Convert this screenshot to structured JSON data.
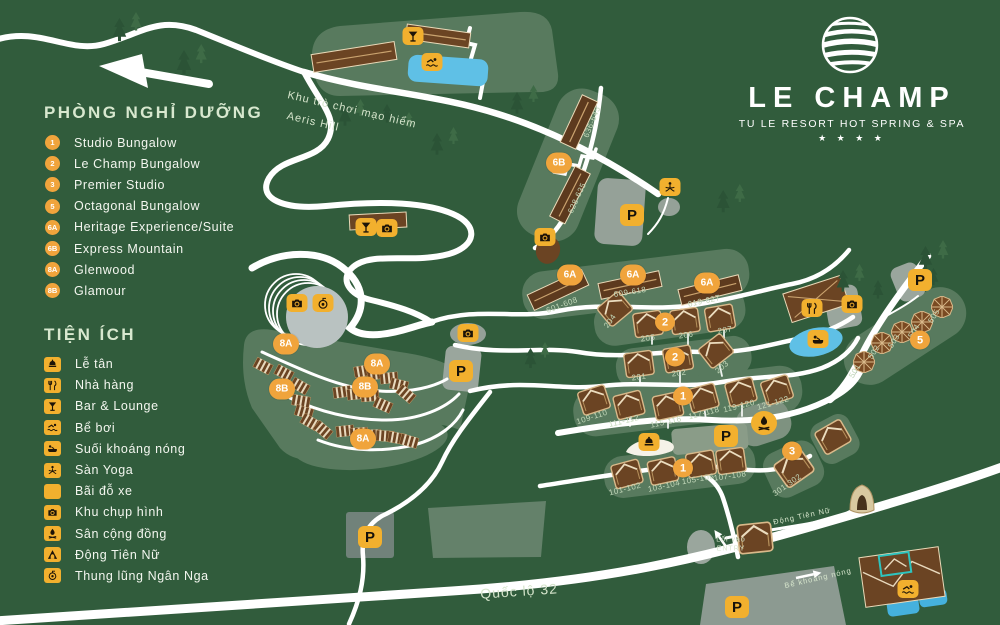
{
  "logo": {
    "name": "LE CHAMP",
    "tagline": "TU LE RESORT HOT SPRING & SPA",
    "stars": "★ ★ ★ ★"
  },
  "legend": {
    "rooms_heading": "PHÒNG NGHỈ DƯỠNG",
    "rooms": [
      {
        "badge": "1",
        "label": "Studio Bungalow"
      },
      {
        "badge": "2",
        "label": "Le Champ Bungalow"
      },
      {
        "badge": "3",
        "label": "Premier Studio"
      },
      {
        "badge": "5",
        "label": "Octagonal Bungalow"
      },
      {
        "badge": "6A",
        "label": "Heritage Experience/Suite"
      },
      {
        "badge": "6B",
        "label": "Express Mountain"
      },
      {
        "badge": "8A",
        "label": "Glenwood"
      },
      {
        "badge": "8B",
        "label": "Glamour"
      }
    ],
    "facilities_heading": "TIỆN ÍCH",
    "facilities": [
      {
        "icon": "reception-icon",
        "label": "Lễ tân"
      },
      {
        "icon": "restaurant-icon",
        "label": "Nhà hàng"
      },
      {
        "icon": "bar-icon",
        "label": "Bar & Lounge"
      },
      {
        "icon": "pool-icon",
        "label": "Bể bơi"
      },
      {
        "icon": "hot-spring-icon",
        "label": "Suối khoáng nóng"
      },
      {
        "icon": "yoga-icon",
        "label": "Sàn Yoga"
      },
      {
        "icon": "parking-icon",
        "label": "Bãi đỗ xe"
      },
      {
        "icon": "photo-icon",
        "label": "Khu chụp hình"
      },
      {
        "icon": "community-icon",
        "label": "Sân cộng đồng"
      },
      {
        "icon": "cave-icon",
        "label": "Động Tiên Nữ"
      },
      {
        "icon": "valley-icon",
        "label": "Thung lũng Ngân Nga"
      }
    ]
  },
  "map": {
    "road_labels": [
      {
        "text": "Khu trò chơi mạo hiểm",
        "x": 352,
        "y": 110,
        "rot": 13,
        "size": 11
      },
      {
        "text": "Aeris Hill",
        "x": 313,
        "y": 122,
        "rot": 13,
        "size": 11
      },
      {
        "text": "Quốc lộ 32",
        "x": 519,
        "y": 591,
        "rot": -4,
        "size": 14
      },
      {
        "text": "Động Tiên Nữ",
        "x": 802,
        "y": 516,
        "rot": -12,
        "size": 7.5
      },
      {
        "text": "Lối vào",
        "x": 731,
        "y": 540,
        "rot": 0,
        "size": 7
      },
      {
        "text": "ENTRY",
        "x": 731,
        "y": 549,
        "rot": 0,
        "size": 7
      },
      {
        "text": "Bể khoáng nóng",
        "x": 818,
        "y": 578,
        "rot": -13,
        "size": 7.5
      }
    ],
    "unit_labels": [
      {
        "text": "636-645",
        "x": 592,
        "y": 122,
        "rot": -68
      },
      {
        "text": "628-635",
        "x": 577,
        "y": 198,
        "rot": -65
      },
      {
        "text": "601-608",
        "x": 562,
        "y": 305,
        "rot": -20
      },
      {
        "text": "609-618",
        "x": 630,
        "y": 292,
        "rot": -9
      },
      {
        "text": "619-627",
        "x": 704,
        "y": 301,
        "rot": -12
      },
      {
        "text": "204",
        "x": 610,
        "y": 321,
        "rot": -55
      },
      {
        "text": "205",
        "x": 648,
        "y": 338,
        "rot": -8
      },
      {
        "text": "206",
        "x": 686,
        "y": 335,
        "rot": -8
      },
      {
        "text": "207",
        "x": 725,
        "y": 330,
        "rot": -10
      },
      {
        "text": "201",
        "x": 639,
        "y": 377,
        "rot": -8
      },
      {
        "text": "202",
        "x": 679,
        "y": 373,
        "rot": -8
      },
      {
        "text": "203",
        "x": 722,
        "y": 367,
        "rot": -40
      },
      {
        "text": "109-110",
        "x": 592,
        "y": 417,
        "rot": -18
      },
      {
        "text": "111-112",
        "x": 624,
        "y": 421,
        "rot": -14
      },
      {
        "text": "115-116",
        "x": 666,
        "y": 422,
        "rot": -12
      },
      {
        "text": "117-118",
        "x": 704,
        "y": 413,
        "rot": -14
      },
      {
        "text": "119-120",
        "x": 739,
        "y": 406,
        "rot": -14
      },
      {
        "text": "121-122",
        "x": 773,
        "y": 403,
        "rot": -16
      },
      {
        "text": "101-102",
        "x": 625,
        "y": 489,
        "rot": -14
      },
      {
        "text": "103-104",
        "x": 664,
        "y": 486,
        "rot": -12
      },
      {
        "text": "105-106",
        "x": 698,
        "y": 479,
        "rot": -10
      },
      {
        "text": "107-108",
        "x": 730,
        "y": 476,
        "rot": -8
      },
      {
        "text": "301-302",
        "x": 787,
        "y": 485,
        "rot": -35
      },
      {
        "text": "501",
        "x": 855,
        "y": 371,
        "rot": -58
      },
      {
        "text": "502",
        "x": 874,
        "y": 352,
        "rot": -58
      },
      {
        "text": "503",
        "x": 894,
        "y": 341,
        "rot": -58
      },
      {
        "text": "504",
        "x": 914,
        "y": 331,
        "rot": -58
      },
      {
        "text": "505",
        "x": 934,
        "y": 316,
        "rot": -58
      }
    ],
    "room_markers": [
      {
        "text": "6B",
        "x": 559,
        "y": 163
      },
      {
        "text": "6A",
        "x": 570,
        "y": 275
      },
      {
        "text": "6A",
        "x": 633,
        "y": 275
      },
      {
        "text": "6A",
        "x": 707,
        "y": 283
      },
      {
        "text": "2",
        "x": 665,
        "y": 322
      },
      {
        "text": "2",
        "x": 675,
        "y": 357
      },
      {
        "text": "1",
        "x": 683,
        "y": 396
      },
      {
        "text": "1",
        "x": 683,
        "y": 468
      },
      {
        "text": "3",
        "x": 792,
        "y": 451
      },
      {
        "text": "5",
        "x": 920,
        "y": 340
      },
      {
        "text": "8A",
        "x": 286,
        "y": 344
      },
      {
        "text": "8A",
        "x": 377,
        "y": 364
      },
      {
        "text": "8B",
        "x": 282,
        "y": 389
      },
      {
        "text": "8B",
        "x": 365,
        "y": 387
      },
      {
        "text": "8A",
        "x": 363,
        "y": 439
      }
    ],
    "facility_markers": [
      {
        "icon": "bar-icon",
        "x": 413,
        "y": 36,
        "kind": "sq"
      },
      {
        "icon": "pool-icon",
        "x": 432,
        "y": 62,
        "kind": "sq"
      },
      {
        "icon": "photo-icon",
        "x": 545,
        "y": 237,
        "kind": "sq"
      },
      {
        "icon": "parking-icon",
        "x": 632,
        "y": 215,
        "kind": "p"
      },
      {
        "icon": "yoga-icon",
        "x": 670,
        "y": 187,
        "kind": "sq"
      },
      {
        "icon": "photo-icon",
        "x": 297,
        "y": 303,
        "kind": "sq"
      },
      {
        "icon": "valley-icon",
        "x": 323,
        "y": 303,
        "kind": "sq"
      },
      {
        "icon": "bar-icon",
        "x": 366,
        "y": 227,
        "kind": "sq"
      },
      {
        "icon": "photo-icon",
        "x": 387,
        "y": 228,
        "kind": "sq"
      },
      {
        "icon": "photo-icon",
        "x": 468,
        "y": 333,
        "kind": "sq"
      },
      {
        "icon": "parking-icon",
        "x": 461,
        "y": 371,
        "kind": "p"
      },
      {
        "icon": "parking-icon",
        "x": 370,
        "y": 537,
        "kind": "p"
      },
      {
        "icon": "reception-icon",
        "x": 649,
        "y": 442,
        "kind": "sq"
      },
      {
        "icon": "parking-icon",
        "x": 726,
        "y": 436,
        "kind": "p"
      },
      {
        "icon": "community-icon",
        "x": 764,
        "y": 423,
        "kind": "round"
      },
      {
        "icon": "parking-icon",
        "x": 920,
        "y": 280,
        "kind": "p"
      },
      {
        "icon": "restaurant-icon",
        "x": 812,
        "y": 308,
        "kind": "sq"
      },
      {
        "icon": "photo-icon",
        "x": 852,
        "y": 304,
        "kind": "sq"
      },
      {
        "icon": "hot-spring-icon",
        "x": 818,
        "y": 339,
        "kind": "sq"
      },
      {
        "icon": "pool-icon",
        "x": 908,
        "y": 589,
        "kind": "sq"
      },
      {
        "icon": "parking-icon",
        "x": 737,
        "y": 607,
        "kind": "p"
      }
    ]
  },
  "colors": {
    "background": "#315c3c",
    "road": "#ffffff",
    "zone": "#587a5e",
    "building": "#6b4423",
    "marker_circle": "#f0a43c",
    "marker_square": "#f2b02e",
    "water": "#5fc0e6",
    "unit_label": "#c3d8ba"
  }
}
